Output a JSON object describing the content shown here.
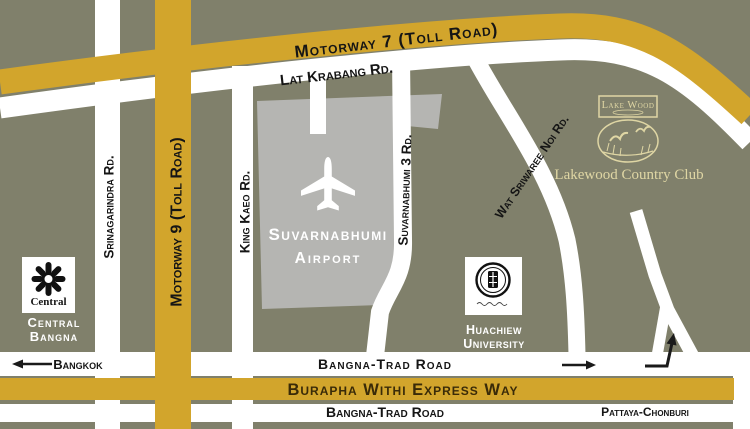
{
  "map": {
    "roads": {
      "motorway7": "Motorway 7 (Toll Road)",
      "lat_krabang": "Lat Krabang Rd.",
      "srinagarindra": "Srinagarindra Rd.",
      "motorway9": "Motorway 9 (Toll Road)",
      "king_kaeo": "King Kaeo Rd.",
      "suvarnabhumi3": "Suvarnabhumi 3 Rd.",
      "wat_sriwaree": "Wat Sriwaree Noi Rd.",
      "bangna_trad_upper": "Bangna-Trad Road",
      "burapha": "Burapha Withi Express Way",
      "bangna_trad_lower": "Bangna-Trad Road"
    },
    "places": {
      "airport": {
        "line1": "Suvarnabhumi",
        "line2": "Airport"
      },
      "central": {
        "logo_text": "Central",
        "line1": "Central",
        "line2": "Bangna"
      },
      "huachiew": {
        "line1": "Huachiew",
        "line2": "University"
      },
      "lakewood": {
        "logo_title": "Lake Wood",
        "caption": "Lakewood Country Club"
      }
    },
    "directions": {
      "bangkok": "Bangkok",
      "pattaya_chonburi": "Pattaya-Chonburi"
    },
    "icons": {
      "airport": "airplane",
      "bangkok": "arrow-left",
      "bangna_trad": "arrow-right",
      "junction": "arrow-turn-up",
      "central": "flower-emblem",
      "huachiew": "round-seal",
      "lakewood": "ducks-in-oval"
    },
    "colors": {
      "background": "#80806B",
      "road_yellow": "#D2A52C",
      "road_white": "#FFFFFF",
      "airport_gray": "#B5B5B2",
      "cream": "#DFD6A4",
      "burapha_text": "#3A2B08",
      "label_black": "#151515"
    }
  }
}
